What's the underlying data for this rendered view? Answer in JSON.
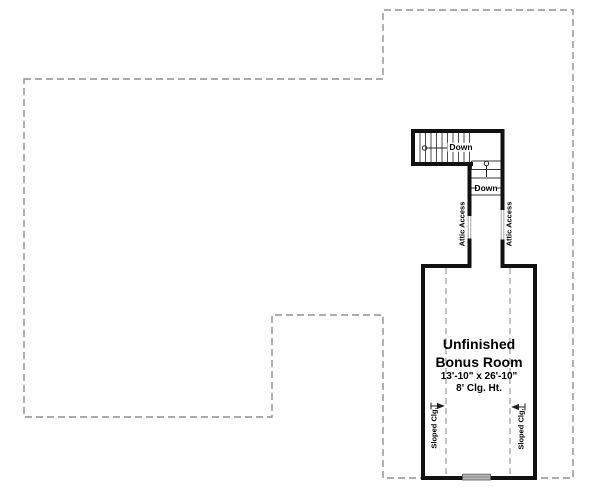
{
  "plan": {
    "room": {
      "title_line1": "Unfinished",
      "title_line2": "Bonus Room",
      "dimensions": "13'-10\" x 26'-10\"",
      "ceiling_height": "8' Clg. Ht."
    },
    "stairs": {
      "upper_down_label": "Down",
      "lower_down_label": "Down"
    },
    "attic_access": {
      "left_label": "Attic Access",
      "right_label": "Attic Access"
    },
    "sloped_ceiling": {
      "left_label": "Sloped Clg.",
      "right_label": "Sloped Clg."
    },
    "colors": {
      "wall": "#111111",
      "boundary_dash": "#8f8f8f",
      "interior_dash": "#9a9a9a",
      "tread_line": "#3a3a3a",
      "arrow": "#222222",
      "window_fill": "#b8b8b8",
      "text": "#000000"
    }
  }
}
